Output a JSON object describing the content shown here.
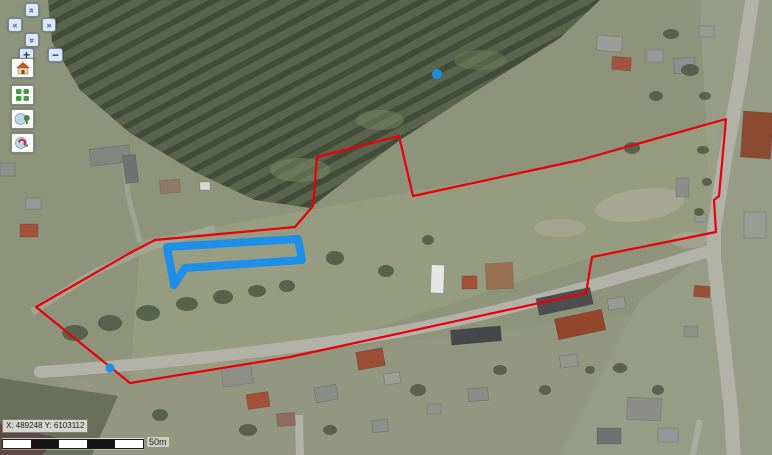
{
  "window": {
    "width": 772,
    "height": 455,
    "app": "web-gis-aerial-map-viewer"
  },
  "map_controls": {
    "pan_up": {
      "glyph": "«",
      "direction": "up"
    },
    "pan_left": {
      "glyph": "«",
      "direction": "left"
    },
    "pan_right": {
      "glyph": "»",
      "direction": "right"
    },
    "pan_down": {
      "glyph": "«",
      "direction": "down"
    },
    "zoom_in": {
      "glyph": "+"
    },
    "zoom_out": {
      "glyph": "−"
    }
  },
  "toolbar": {
    "buttons": [
      {
        "id": "home",
        "icon": "house-icon"
      },
      {
        "id": "layer-grid",
        "icon": "green-grid-icon"
      },
      {
        "id": "tree-tool",
        "icon": "balloon-tree-icon"
      },
      {
        "id": "marker-tool",
        "icon": "balloon-marker-icon"
      }
    ]
  },
  "status": {
    "coordinates": "X: 489248 Y: 6103112"
  },
  "scalebar": {
    "label": "50m",
    "segment_count": 5,
    "length_px": 140
  },
  "overlays": {
    "boundary_color": "#e8000a",
    "highlight_color": "#1d8fe8",
    "red_boundary": {
      "points": "36,307 130,253 155,240 295,227 313,206 317,157 399,136 413,196 580,160 726,119 719,196 714,200 716,232 592,257 586,293 290,357 130,383"
    },
    "blue_shape": {
      "points": "167,247 298,239 302,260 185,268 174,285"
    },
    "markers": [
      {
        "cx": 437,
        "cy": 74,
        "r": 5
      },
      {
        "cx": 110,
        "cy": 368,
        "r": 4.5
      }
    ]
  }
}
